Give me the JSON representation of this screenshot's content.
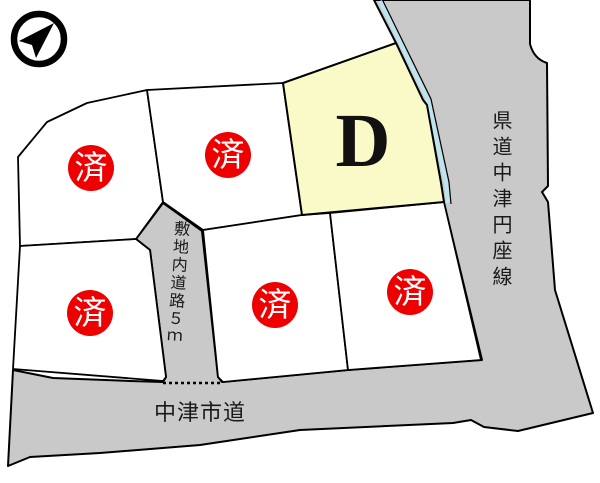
{
  "lots": {
    "sold_marker": "済",
    "featured_lot": {
      "label": "D",
      "fill": "#FAFAC8"
    },
    "sold_lot_count": 5
  },
  "roads": {
    "prefectural": {
      "name": "県道中津円座線",
      "orientation": "vertical"
    },
    "city": {
      "name": "中津市道",
      "orientation": "horizontal"
    },
    "internal": {
      "name": "敷地内道路５ｍ",
      "orientation": "vertical"
    }
  },
  "icons": {
    "compass": "north-arrow-icon"
  },
  "colors": {
    "road_fill": "#C9C9C9",
    "featured_lot_fill": "#FAFAC8",
    "lot_fill": "#FFFFFF",
    "sold_badge": "#EE0000",
    "sold_badge_text": "#FFFFFF",
    "boundary": "#000000",
    "water_strip": "#BDE5F0"
  }
}
